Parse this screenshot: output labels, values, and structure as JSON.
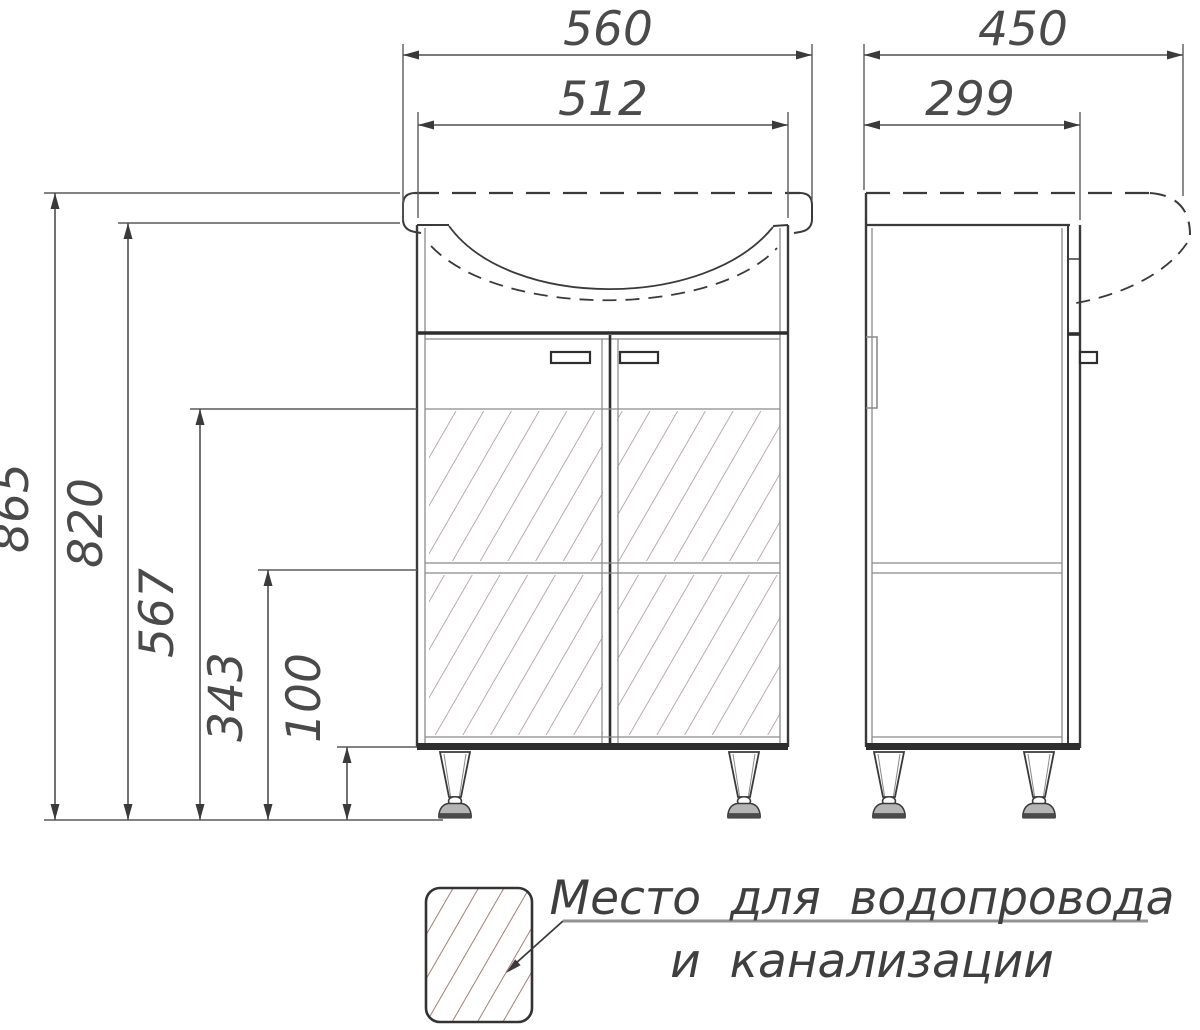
{
  "drawing": {
    "object": "vanity-cabinet-with-sink-technical-drawing",
    "views": [
      "front",
      "side"
    ]
  },
  "dimensions": {
    "front": {
      "sink_width": "560",
      "cabinet_width": "512",
      "total_height": "865",
      "height_to_counter": "820",
      "plumbing_zone_top_height": "567",
      "shelf_height": "343",
      "leg_height": "100"
    },
    "side": {
      "sink_depth": "450",
      "cabinet_depth": "299"
    }
  },
  "legend": {
    "line1": "Место для водопровода",
    "line2": "и канализации"
  },
  "colors": {
    "line": "#3a3a3a",
    "thick_line": "#2e2e2e",
    "secondary_line": "#8a8a8a",
    "hatch_front": "#a8908c",
    "hatch_legend": "#9c6a5e",
    "foot_fill": "#b5b5b5"
  }
}
